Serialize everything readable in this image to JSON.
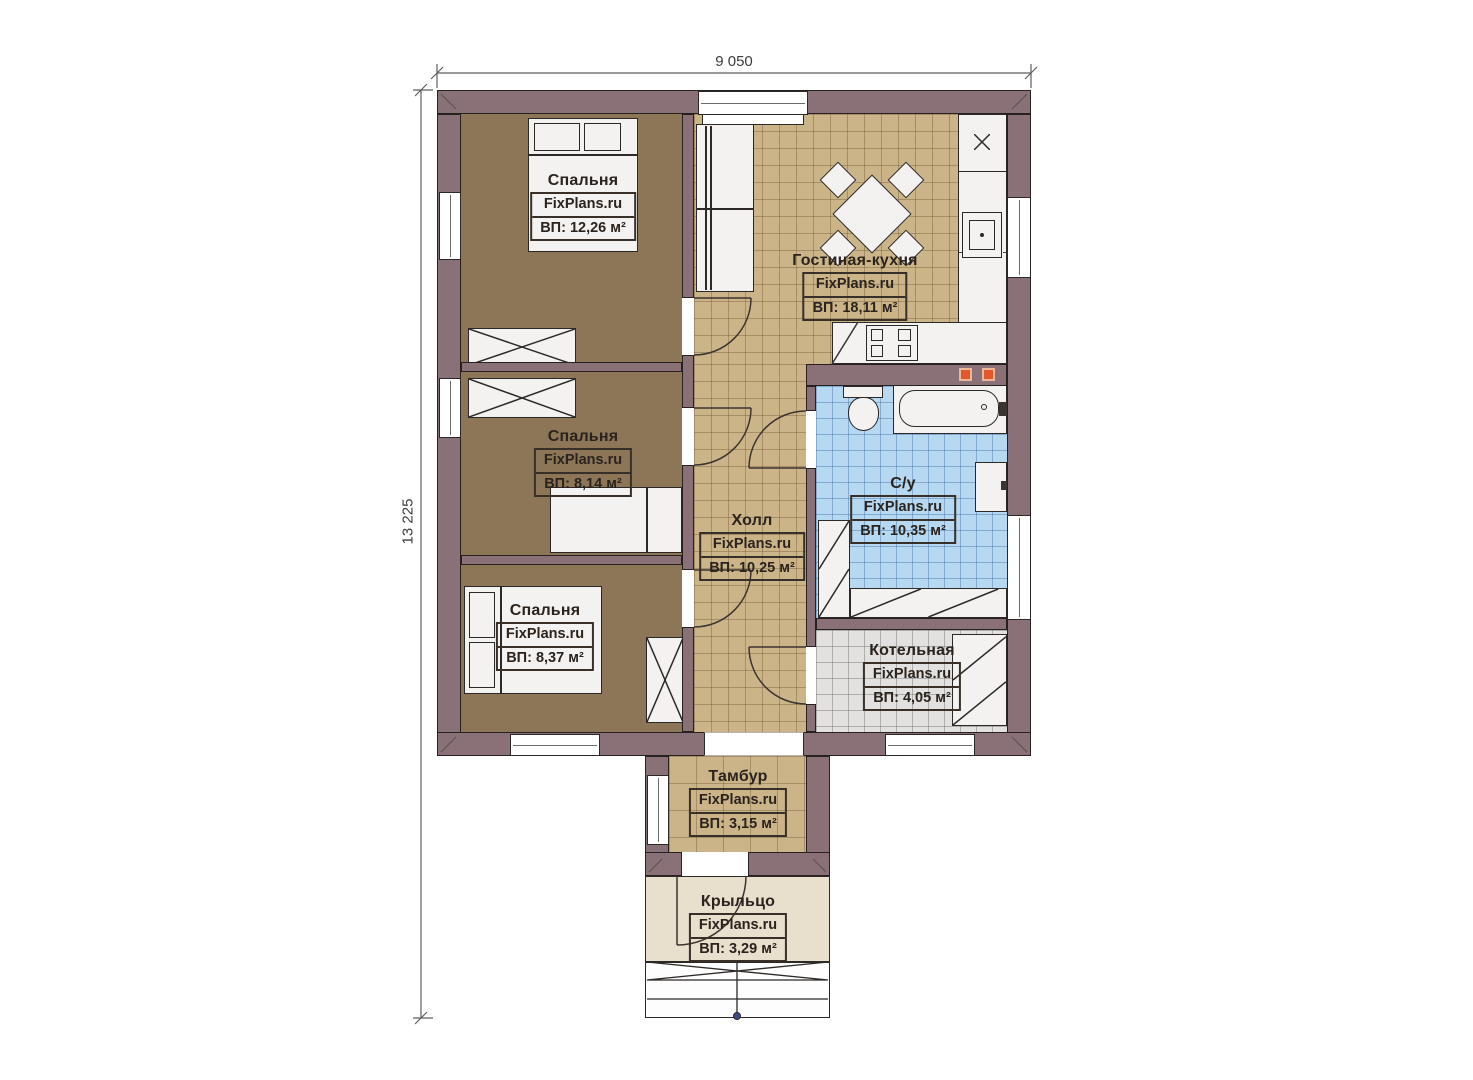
{
  "dimensions": {
    "width_label": "9 050",
    "height_label": "13 225"
  },
  "watermark": "FixPlans.ru",
  "rooms": [
    {
      "key": "bedroom-1",
      "name": "Спальня",
      "area": "ВП: 12,26 м²"
    },
    {
      "key": "living-kitchen",
      "name": "Гостиная-кухня",
      "area": "ВП: 18,11 м²"
    },
    {
      "key": "bedroom-2",
      "name": "Спальня",
      "area": "ВП: 8,14 м²"
    },
    {
      "key": "hall",
      "name": "Холл",
      "area": "ВП: 10,25 м²"
    },
    {
      "key": "bathroom",
      "name": "С/у",
      "area": "ВП: 10,35 м²"
    },
    {
      "key": "bedroom-3",
      "name": "Спальня",
      "area": "ВП: 8,37 м²"
    },
    {
      "key": "boiler-room",
      "name": "Котельная",
      "area": "ВП: 4,05 м²"
    },
    {
      "key": "vestibule",
      "name": "Тамбур",
      "area": "ВП: 3,15 м²"
    },
    {
      "key": "porch",
      "name": "Крыльцо",
      "area": "ВП: 3,29 м²"
    }
  ],
  "colors": {
    "wall": "#8a7178",
    "bedroom_floor": "#8d7557",
    "tile_floor": "#ccb489",
    "bathroom_floor": "#b7d8f1",
    "boiler_floor": "#e2e1df",
    "porch_floor": "#e8dfcd",
    "accent_orange": "#e2572b"
  }
}
